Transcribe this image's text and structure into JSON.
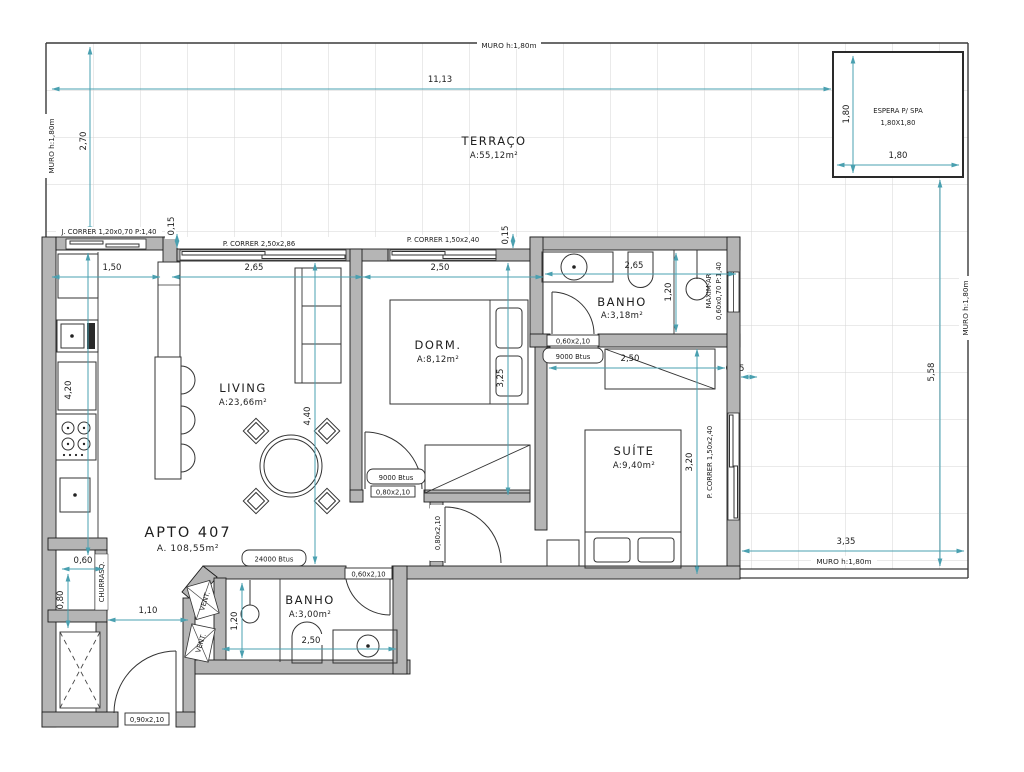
{
  "plan": {
    "apto": {
      "name": "APTO 407",
      "area": "A. 108,55m²"
    },
    "rooms": {
      "terraco": {
        "name": "TERRAÇO",
        "area": "A:55,12m²"
      },
      "living": {
        "name": "LIVING",
        "area": "A:23,66m²"
      },
      "dorm": {
        "name": "DORM.",
        "area": "A:8,12m²"
      },
      "banho1": {
        "name": "BANHO",
        "area": "A:3,18m²"
      },
      "suite": {
        "name": "SUÍTE",
        "area": "A:9,40m²"
      },
      "banho2": {
        "name": "BANHO",
        "area": "A:3,00m²"
      },
      "espera": {
        "name": "ESPERA P/ SPA",
        "size": "1,80X1,80"
      },
      "churrasq": {
        "name": "CHURRASQ."
      },
      "vent": {
        "name": "VENT."
      }
    },
    "muro": {
      "top": "MURO h:1,80m",
      "left": "MURO h:1,80m",
      "right": "MURO h:1,80m",
      "bottom": "MURO h:1,80m"
    },
    "openings": {
      "j_correr": "J. CORRER 1,20x0,70 P:1,40",
      "p_correr_living": "P. CORRER 2,50x2,86",
      "p_correr_dorm": "P. CORRER 1,50x2,40",
      "p_correr_suite": "P. CORRER 1,50x2,40",
      "maxim_ar_1": "MAXIM-AR",
      "maxim_ar_2": "0,60x0,70 P:1,40",
      "door_banho1": "0,60x2,10",
      "door_dorm": "0,80x2,10",
      "door_suite": "0,80x2,10",
      "door_banho2": "0,60x2,10",
      "door_entry": "0,90x2,10"
    },
    "hvac": {
      "dorm": "9000 Btus",
      "suite": "9000 Btus",
      "living": "24000 Btus"
    },
    "dims": {
      "terrace_w": "11,13",
      "terrace_h": "2,70",
      "spa_w": "1,80",
      "spa_h": "1,80",
      "kitchen_w": "1,50",
      "living_w": "2,65",
      "dorm_w": "2,50",
      "banho1_w": "2,65",
      "banho1_h": "1,20",
      "step_a": "0,15",
      "step_b": "0,15",
      "step_c": "0,15",
      "kitchen_h": "4,20",
      "living_h": "4,40",
      "dorm_h": "3,25",
      "suite_w": "2,50",
      "suite_h": "3,20",
      "right_h": "5,58",
      "bottom_w": "3,35",
      "churrasq_w": "0,60",
      "churrasq_h": "0,80",
      "hall_w": "1,10",
      "banho2_h": "1,20",
      "banho2_w": "2,50"
    },
    "colors": {
      "dim_line": "#4aa0b0",
      "wall_fill": "#b5b5b5",
      "grid": "#d6d6d6"
    }
  }
}
